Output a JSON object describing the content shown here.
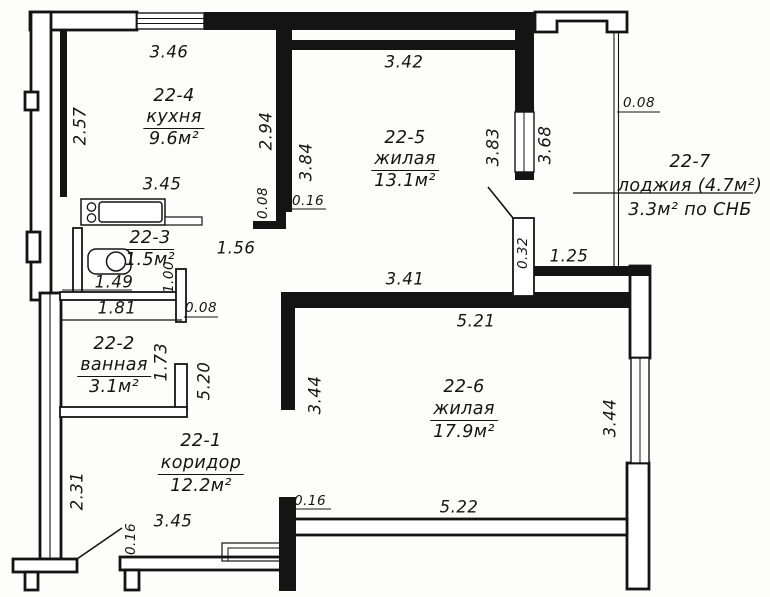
{
  "colors": {
    "ink": "#141414",
    "paper": "#fdfdfc"
  },
  "rooms": {
    "kitchen": {
      "id": "22-4",
      "name": "кухня",
      "area": "9.6м²"
    },
    "living1": {
      "id": "22-5",
      "name": "жилая",
      "area": "13.1м²"
    },
    "wc": {
      "id": "22-3",
      "area": "1.5м²"
    },
    "bathroom": {
      "id": "22-2",
      "name": "ванная",
      "area": "3.1м²"
    },
    "corridor": {
      "id": "22-1",
      "name": "коридор",
      "area": "12.2м²"
    },
    "living2": {
      "id": "22-6",
      "name": "жилая",
      "area": "17.9м²"
    },
    "loggia": {
      "id": "22-7",
      "name": "лоджия (4.7м²)",
      "area": "3.3м² по СНБ"
    }
  },
  "dimensions": {
    "d1": "3.46",
    "d2": "3.42",
    "d3": "0.08",
    "d4": "2.57",
    "d5": "2.94",
    "d6": "3.84",
    "d7": "3.83",
    "d8": "3.68",
    "d9": "3.45",
    "d10": "0.08",
    "d11": "0.16",
    "d12": "1.56",
    "d13": "1.49",
    "d14": "1.00",
    "d15": "0.32",
    "d16": "1.25",
    "d17": "3.41",
    "d18": "1.81",
    "d19": "0.08",
    "d20": "5.21",
    "d21": "1.73",
    "d22": "5.20",
    "d23": "3.44",
    "d24": "3.44",
    "d25": "2.31",
    "d26": "0.16",
    "d27": "3.45",
    "d28": "0.16",
    "d29": "5.22"
  }
}
